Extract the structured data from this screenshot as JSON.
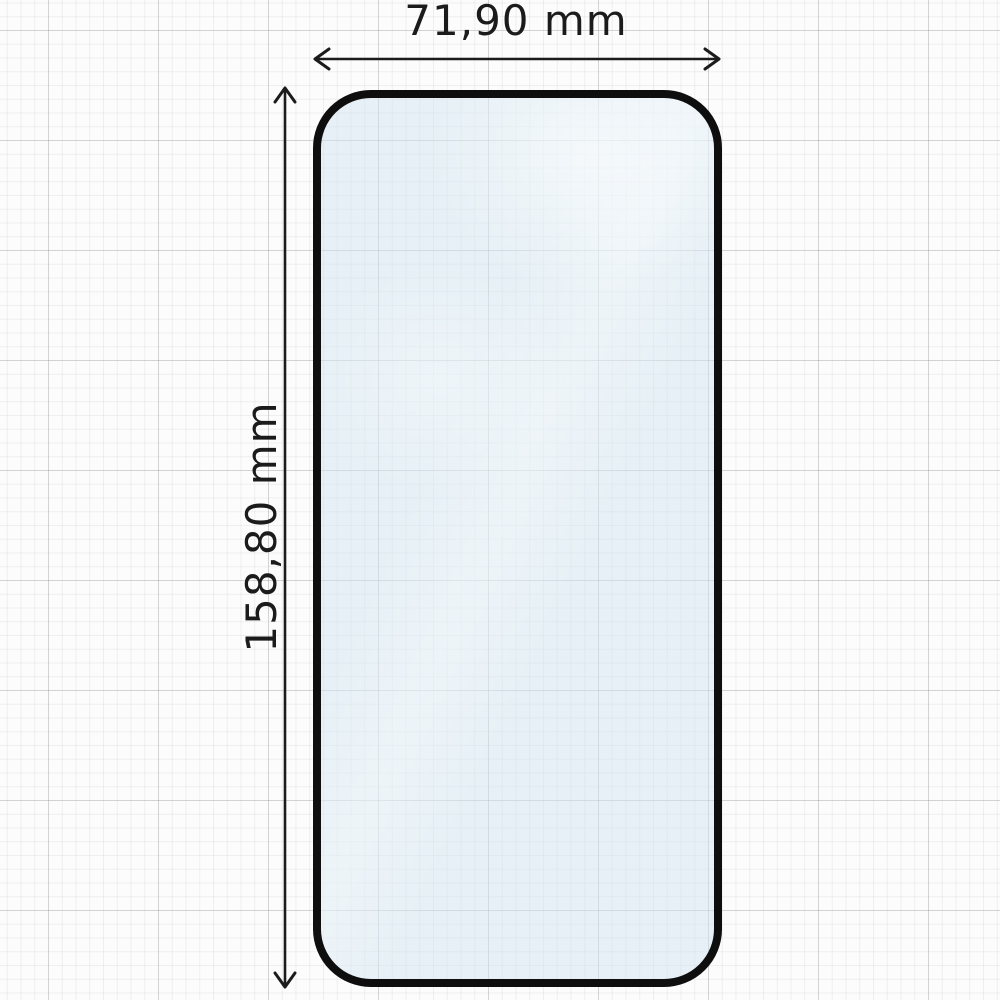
{
  "diagram": {
    "kind": "screen-protector-dimension-diagram",
    "dimensions": {
      "width_label": "71,90 mm",
      "height_label": "158,80 mm"
    }
  },
  "colors": {
    "line": "#1b1b1b",
    "protector_border": "#0e0e0e",
    "glass_tint": "#cfe3ef80",
    "paper": "#fcfcfc"
  }
}
